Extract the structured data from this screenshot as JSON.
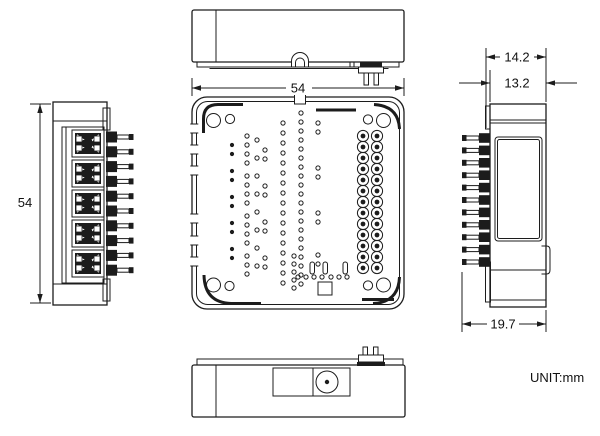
{
  "meta": {
    "background_color": "#ffffff",
    "line_color": "#1c1c1c"
  },
  "labels": {
    "unit": "UNIT:mm"
  },
  "dimensions": {
    "top_width": "54",
    "left_height": "54",
    "right_overall_width": "14.2",
    "right_body_width": "13.2",
    "right_depth": "19.7"
  },
  "features": {
    "right_header_rows": 13,
    "right_header_cols": 2,
    "left_view_pin_count": 10,
    "right_view_pin_count": 11,
    "left_view_connector_count": 5
  }
}
